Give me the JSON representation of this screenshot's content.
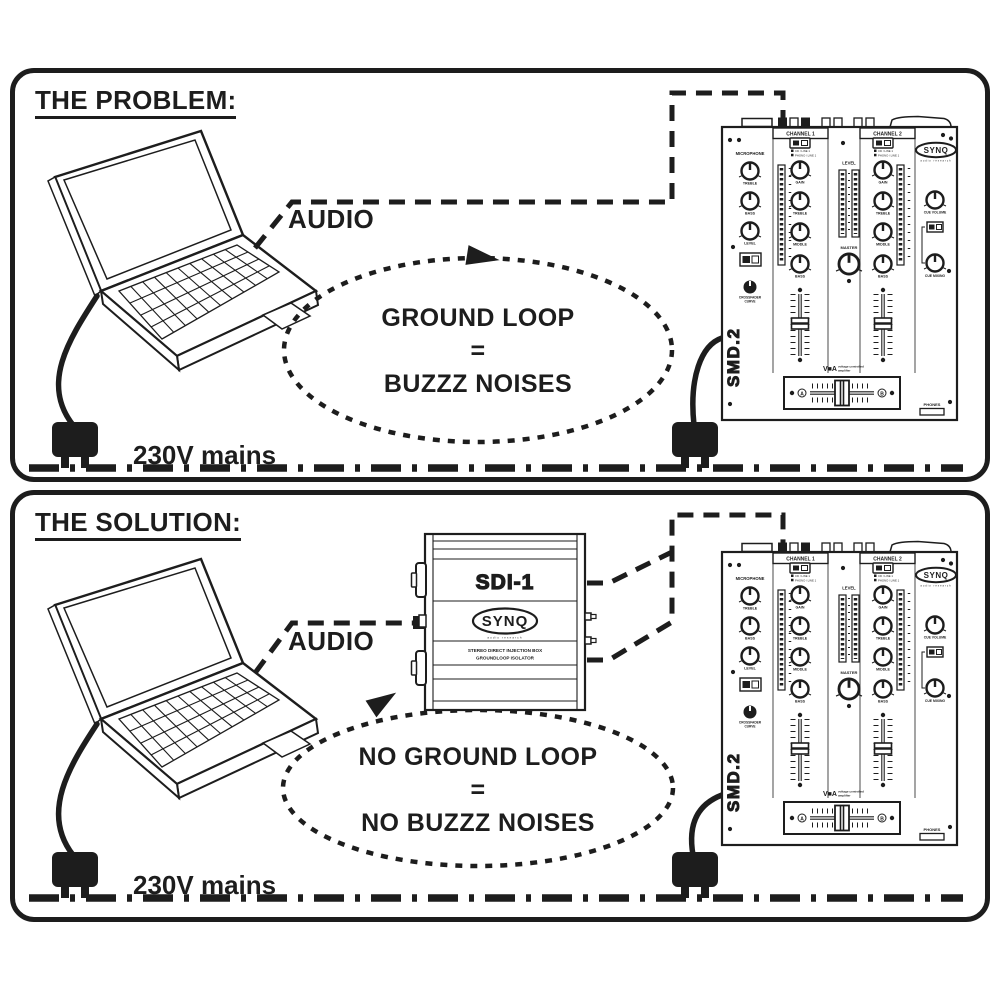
{
  "problem_panel": {
    "title": "THE PROBLEM:",
    "audio_label": "AUDIO",
    "mains_label": "230V mains",
    "loop_line1": "GROUND LOOP",
    "loop_line2": "=",
    "loop_line3": "BUZZZ NOISES"
  },
  "solution_panel": {
    "title": "THE SOLUTION:",
    "audio_label": "AUDIO",
    "mains_label": "230V mains",
    "loop_line1": "NO GROUND LOOP",
    "loop_line2": "=",
    "loop_line3": "NO BUZZZ NOISES"
  },
  "mixer": {
    "brand": "SYNQ",
    "brand_sub": "audio research",
    "model": "SMD.2",
    "channel1": "CHANNEL 1",
    "channel2": "CHANNEL 2",
    "microphone": "MICROPHONE",
    "mic_knob1": "TREBLE",
    "mic_knob2": "BASS",
    "mic_knob3": "LEVEL",
    "selector_line1": "CD / LINE 1",
    "selector_line2": "PHONO / LINE 1",
    "knob_gain": "GAIN",
    "knob_treble": "TREBLE",
    "knob_middle": "MIDDLE",
    "knob_bass": "BASS",
    "level": "LEVEL",
    "master": "MASTER",
    "cue_volume": "CUE VOLUME",
    "cue_mixing": "CUE MIXING",
    "crossfader_curve1": "CROSSFADER",
    "crossfader_curve2": "CURVE",
    "vca_logo": "V■A",
    "vca_line1": "voltage controlled",
    "vca_line2": "amplifier",
    "xfade_a": "A",
    "xfade_b": "B",
    "phones": "PHONES"
  },
  "isolator": {
    "model": "SDI-1",
    "brand": "SYNQ",
    "brand_sub": "audio research",
    "desc_line1": "STEREO DIRECT INJECTION BOX",
    "desc_line2": "GROUNDLOOP ISOLATOR"
  },
  "colors": {
    "ink": "#1d1d1d",
    "paper": "#ffffff"
  }
}
